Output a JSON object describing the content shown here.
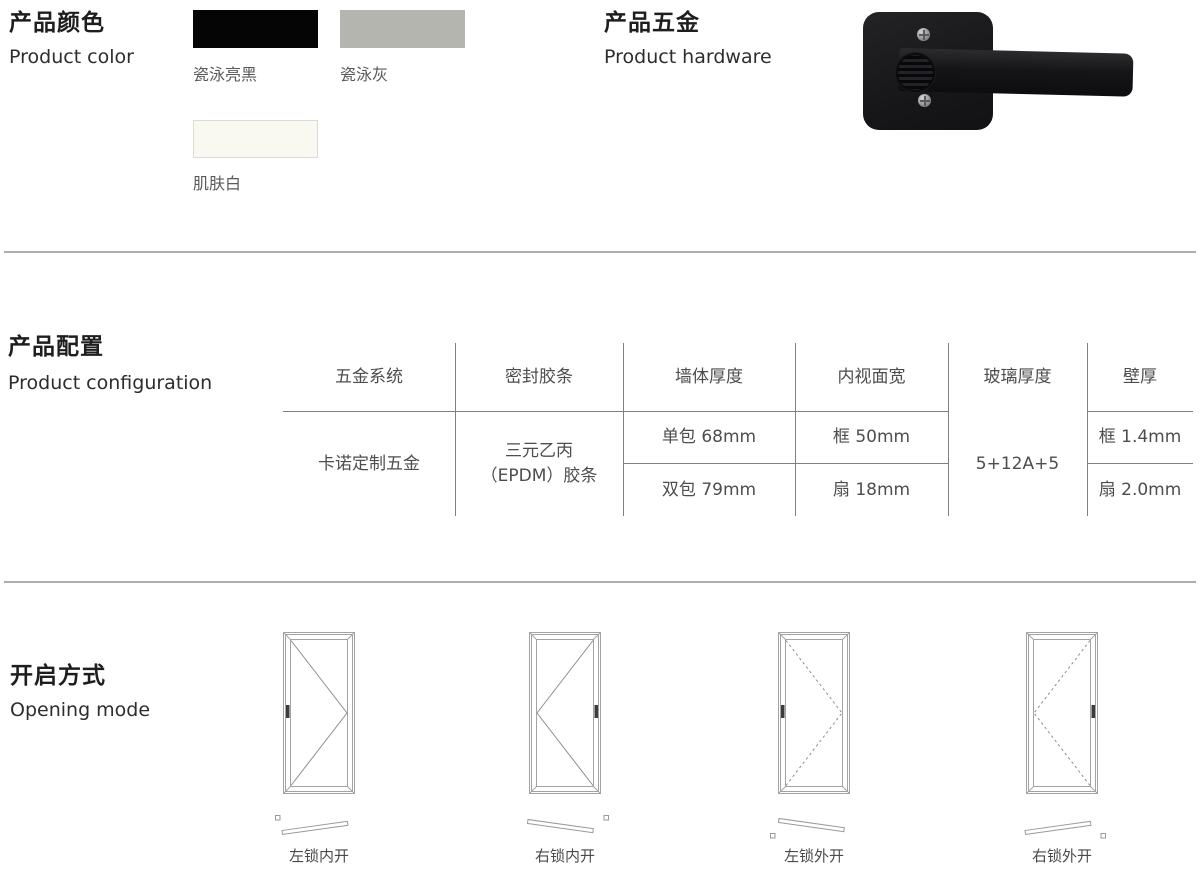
{
  "sections": {
    "color": {
      "title_cn": "产品颜色",
      "title_en": "Product color",
      "swatches": [
        {
          "name": "瓷泳亮黑",
          "hex": "#050505"
        },
        {
          "name": "瓷泳灰",
          "hex": "#b3b5ae"
        },
        {
          "name": "肌肤白",
          "hex": "#faf9f1"
        }
      ]
    },
    "hardware": {
      "title_cn": "产品五金",
      "title_en": "Product hardware"
    },
    "config": {
      "title_cn": "产品配置",
      "title_en": "Product configuration",
      "table": {
        "headers": [
          "五金系统",
          "密封胶条",
          "墙体厚度",
          "内视面宽",
          "玻璃厚度",
          "壁厚"
        ],
        "values": {
          "hardware_system": "卡诺定制五金",
          "seal_strip": [
            "三元乙丙",
            "（EPDM）胶条"
          ],
          "wall_thickness": [
            "单包 68mm",
            "双包 79mm"
          ],
          "inner_face_width": [
            "框 50mm",
            "扇 18mm"
          ],
          "glass_thickness": "5+12A+5",
          "profile_thickness": [
            "框 1.4mm",
            "扇 2.0mm"
          ]
        }
      }
    },
    "opening": {
      "title_cn": "开启方式",
      "title_en": "Opening mode",
      "modes": [
        {
          "label": "左锁内开",
          "line_style": "solid",
          "apex": "right",
          "handle_side": "left"
        },
        {
          "label": "右锁内开",
          "line_style": "solid",
          "apex": "left",
          "handle_side": "right"
        },
        {
          "label": "左锁外开",
          "line_style": "dashed",
          "apex": "right",
          "handle_side": "left"
        },
        {
          "label": "右锁外开",
          "line_style": "dashed",
          "apex": "left",
          "handle_side": "right"
        }
      ]
    }
  },
  "ui_colors": {
    "divider": "#aeaeae",
    "table_line": "#808080",
    "body_text": "#4d4d4d"
  }
}
